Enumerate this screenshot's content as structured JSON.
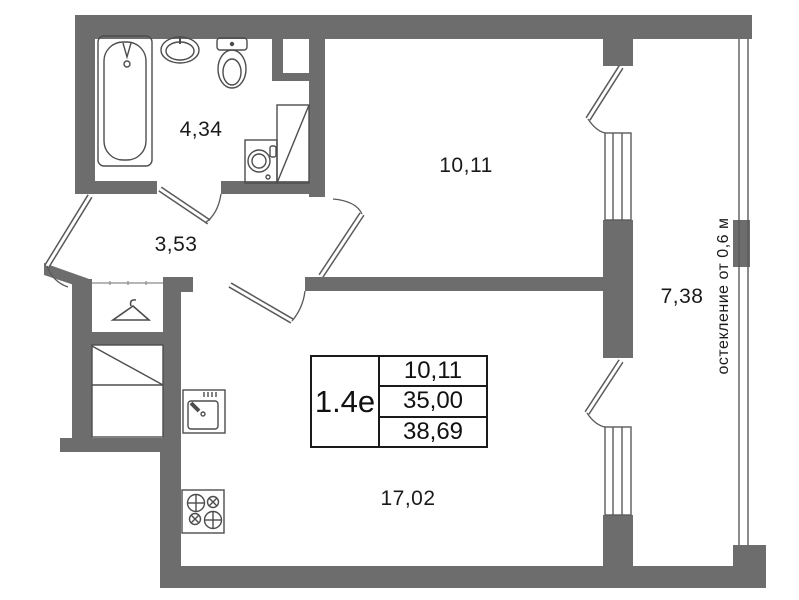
{
  "rooms": [
    {
      "id": "bathroom",
      "area": "4,34"
    },
    {
      "id": "hallway",
      "area": "3,53"
    },
    {
      "id": "bedroom",
      "area": "10,11"
    },
    {
      "id": "kitchen-living",
      "area": "17,02"
    },
    {
      "id": "balcony",
      "area": "7,38"
    }
  ],
  "info_table": {
    "unit": "1.4е",
    "values": [
      "10,11",
      "35,00",
      "38,69"
    ]
  },
  "glazing_note": "остекление от 0,6 м",
  "fixtures": [
    "bathtub",
    "washbasin",
    "toilet",
    "washing-machine",
    "shaft",
    "wardrobe-hanger",
    "closet",
    "kitchen-sink",
    "stove"
  ],
  "colors": {
    "wall": "#6d6d6d",
    "line": "#555555",
    "text": "#1a1a1a"
  }
}
